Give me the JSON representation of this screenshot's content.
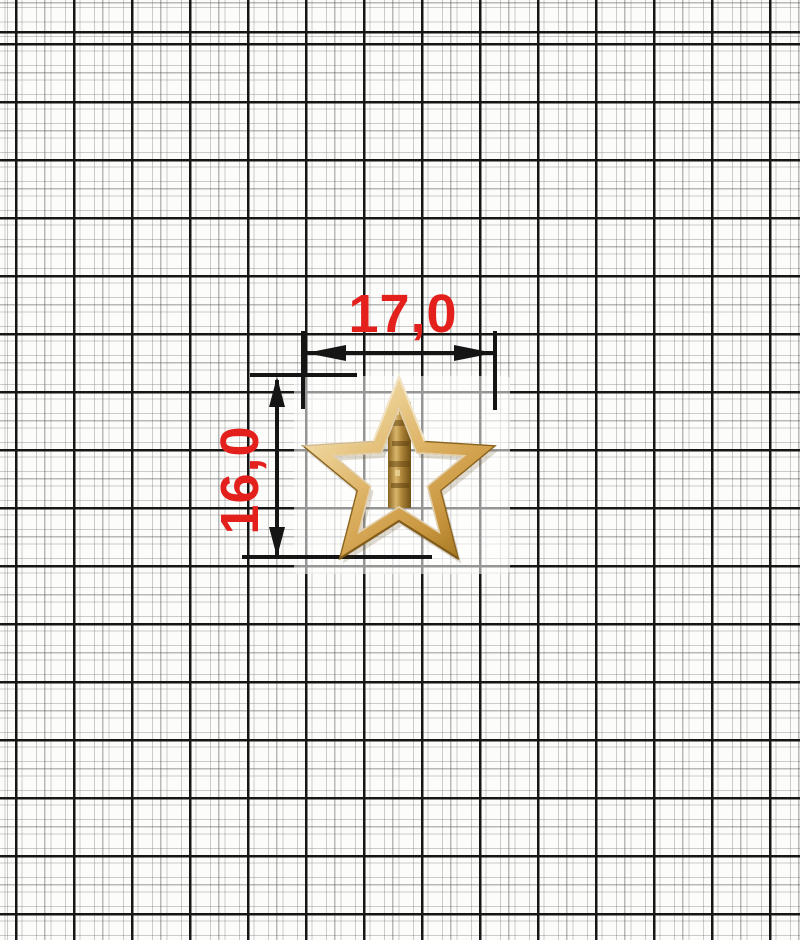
{
  "paper": {
    "background_color": "#fcfcfa",
    "minor_line_color": "#a8a8a8",
    "major_line_color": "#161616"
  },
  "dimensions": {
    "text_color": "#e3201b",
    "line_color": "#151515",
    "width": {
      "label": "17,0"
    },
    "height": {
      "label": "16,0"
    }
  },
  "ornament": {
    "kind": "open five-pointed star with center bar",
    "colors": {
      "highlight": "#faf0d8",
      "light": "#ecd195",
      "mid": "#dcb061",
      "deep": "#c9963f",
      "shadow": "#a2751f",
      "edge_stroke": "#8a641e",
      "post_dark": "#6f5014"
    }
  }
}
